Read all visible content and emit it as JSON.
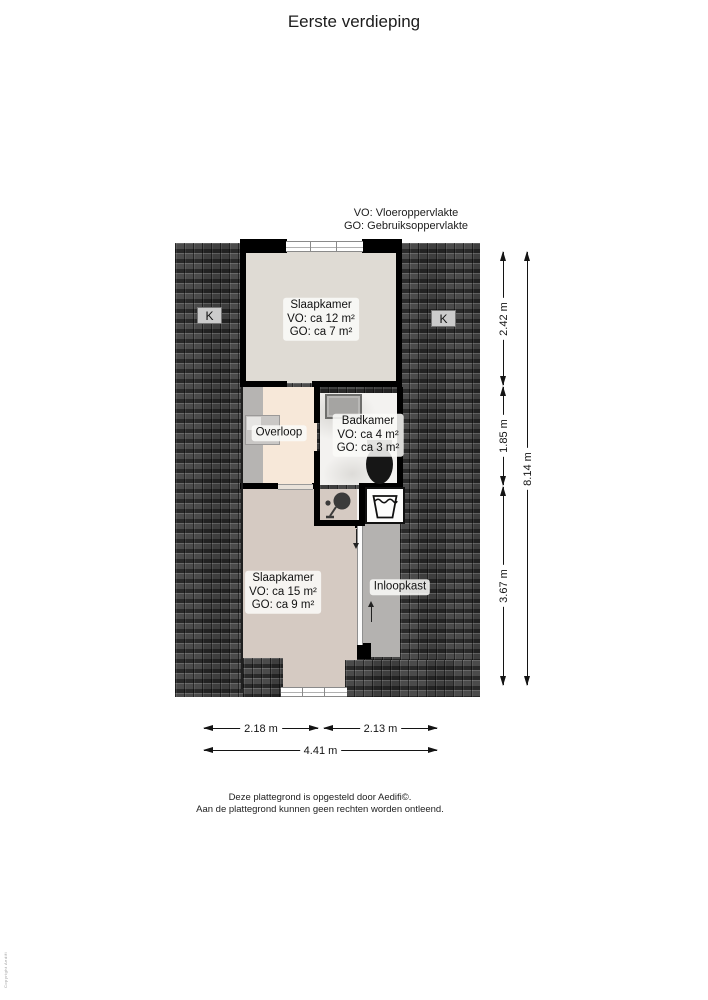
{
  "title": "Eerste verdieping",
  "legend": {
    "vo": "VO: Vloeroppervlakte",
    "go": "GO: Gebruiksoppervlakte"
  },
  "rooms": {
    "bedroom_top": {
      "name": "Slaapkamer",
      "vo": "VO: ca 12 m²",
      "go": "GO: ca 7 m²"
    },
    "landing": {
      "name": "Overloop"
    },
    "bathroom": {
      "name": "Badkamer",
      "vo": "VO: ca 4 m²",
      "go": "GO: ca 3 m²"
    },
    "bedroom_bottom": {
      "name": "Slaapkamer",
      "vo": "VO: ca 15 m²",
      "go": "GO: ca 9 m²"
    },
    "closet": {
      "name": "Inloopkast"
    }
  },
  "dormer_left": "K",
  "dormer_right": "K",
  "dimensions": {
    "v1": "2.42 m",
    "v2": "1.85 m",
    "v3": "3.67 m",
    "v_total": "8.14 m",
    "h1": "2.18 m",
    "h2": "2.13 m",
    "h_total": "4.41 m"
  },
  "footer": {
    "line1": "Deze plattegrond is opgesteld door Aedifi©.",
    "line2": "Aan de plattegrond kunnen geen rechten worden ontleend."
  },
  "watermark": "Copyright Aedifi",
  "colors": {
    "roof": "#4b4b4b",
    "wall": "#000000",
    "bedroom_top_fill": "#dfdbd4",
    "landing_fill": "#f7e8d9",
    "bedroom_bottom_fill": "#d5cac2",
    "closet_fill": "#b4b2b0"
  }
}
